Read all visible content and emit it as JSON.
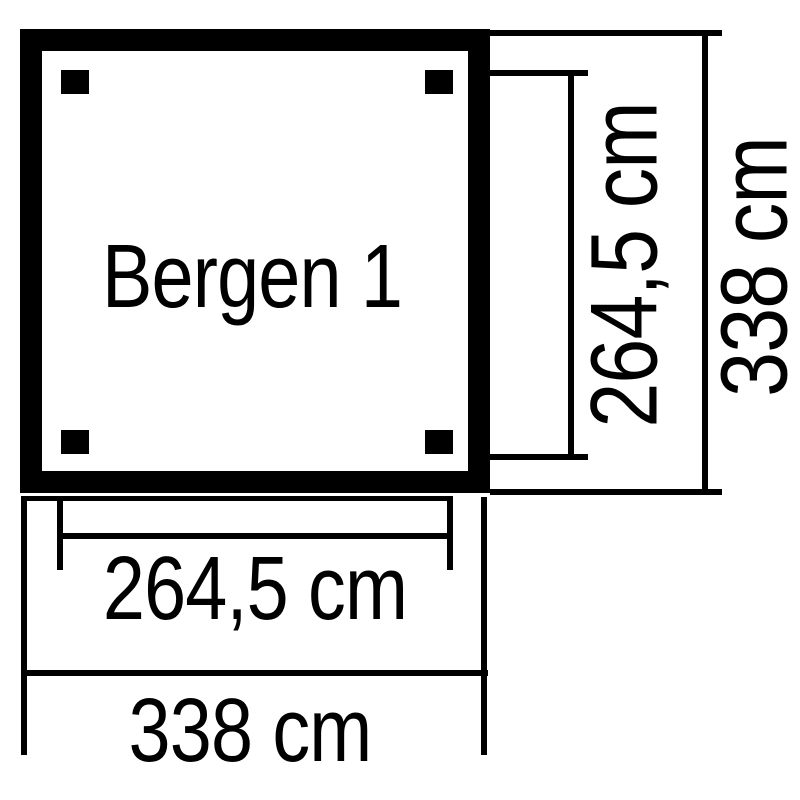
{
  "colors": {
    "line": "#000000",
    "background": "#ffffff"
  },
  "plan": {
    "label": "Bergen 1",
    "shape": "square",
    "post_count": 4
  },
  "dimensions": {
    "side_inner": {
      "label": "264,5 cm",
      "value_cm": 264.5,
      "orientation": "vertical",
      "measures": "post-to-post height (inner)"
    },
    "side_outer": {
      "label": "338 cm",
      "value_cm": 338,
      "orientation": "vertical",
      "measures": "overall height (outer)"
    },
    "bottom_inner": {
      "label": "264,5 cm",
      "value_cm": 264.5,
      "orientation": "horizontal",
      "measures": "post-to-post width (inner)"
    },
    "bottom_outer": {
      "label": "338 cm",
      "value_cm": 338,
      "orientation": "horizontal",
      "measures": "overall width (outer)"
    }
  }
}
